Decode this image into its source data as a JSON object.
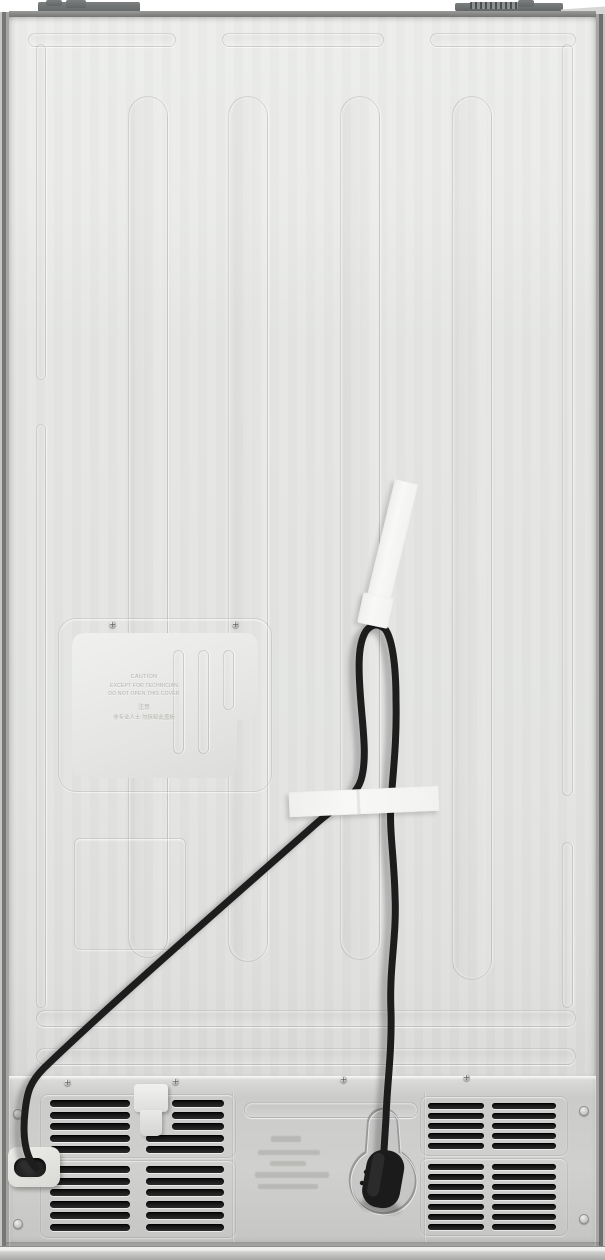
{
  "access_cover": {
    "label_lines": {
      "line1": "CAUTION",
      "line2": "EXCEPT FOR TECHNICIAN",
      "line3": "DO NOT OPEN THIS COVER",
      "line4": "注意",
      "line5": "非专业人士 勿拆卸此盖板"
    }
  },
  "colors": {
    "back_sheet": "#e6e6e4",
    "frame_rail": "#7c7c7a",
    "bottom_machine_panel": "#cbccca",
    "power_cord": "#1d1d1d",
    "masking_tape": "#f6f6f4",
    "vent_slot": "#141414",
    "plug_body": "#1b1b1b"
  }
}
